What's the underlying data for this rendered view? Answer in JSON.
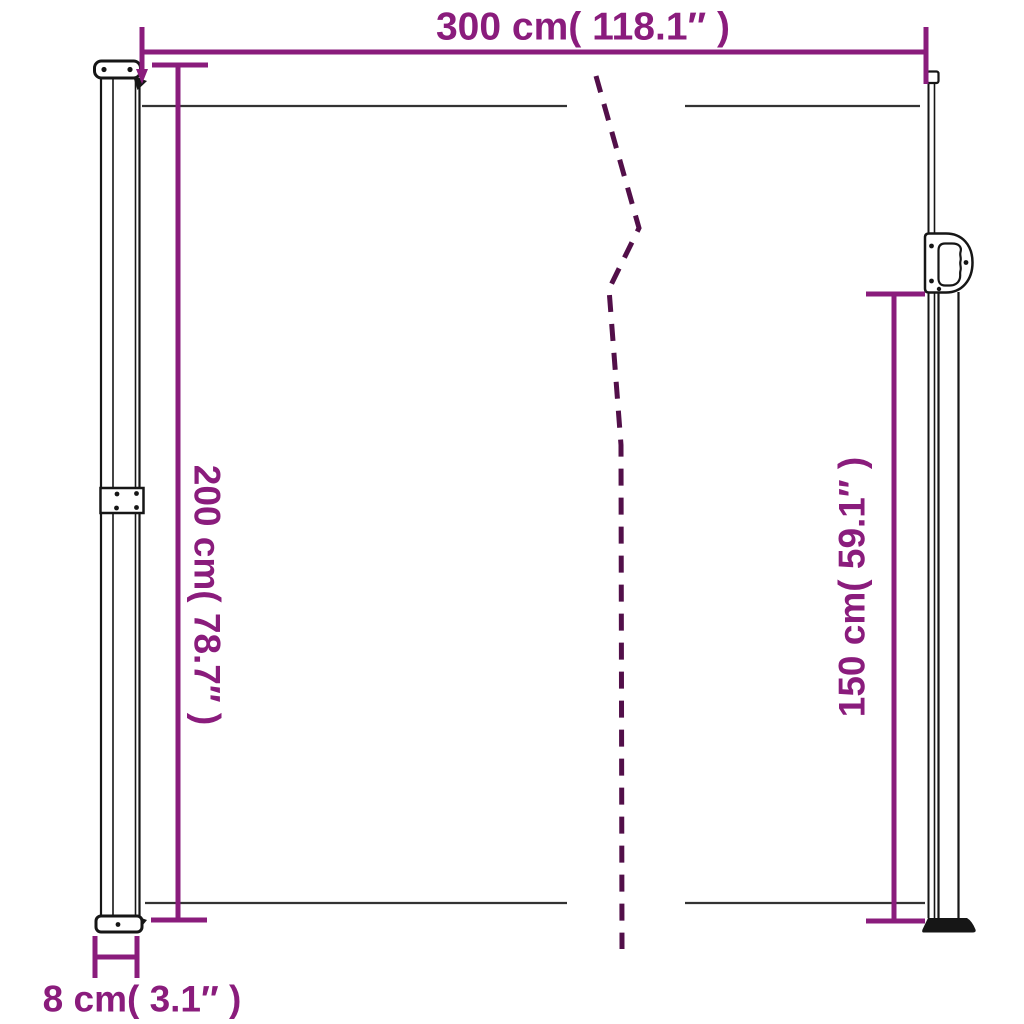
{
  "diagram": {
    "kind": "retractable-side-awning-dimension-diagram",
    "labels": {
      "width_top": "300 cm( 118.1″ )",
      "height_left": "200 cm( 78.7″ )",
      "height_right": "150 cm( 59.1″ )",
      "pole_depth_bottom": "8 cm( 3.1″ )"
    },
    "values": {
      "width_top": {
        "cm": "300",
        "inches": "118.1"
      },
      "height_left": {
        "cm": "200",
        "inches": "78.7"
      },
      "height_right": {
        "cm": "150",
        "inches": "59.1"
      },
      "pole_depth_bottom": {
        "cm": "8",
        "inches": "3.1"
      }
    }
  },
  "colors": {
    "dimension": "#8A1C7C",
    "dash": "#520F49",
    "outline": "#161616",
    "fabric_line": "#333333",
    "background": "#ffffff"
  }
}
